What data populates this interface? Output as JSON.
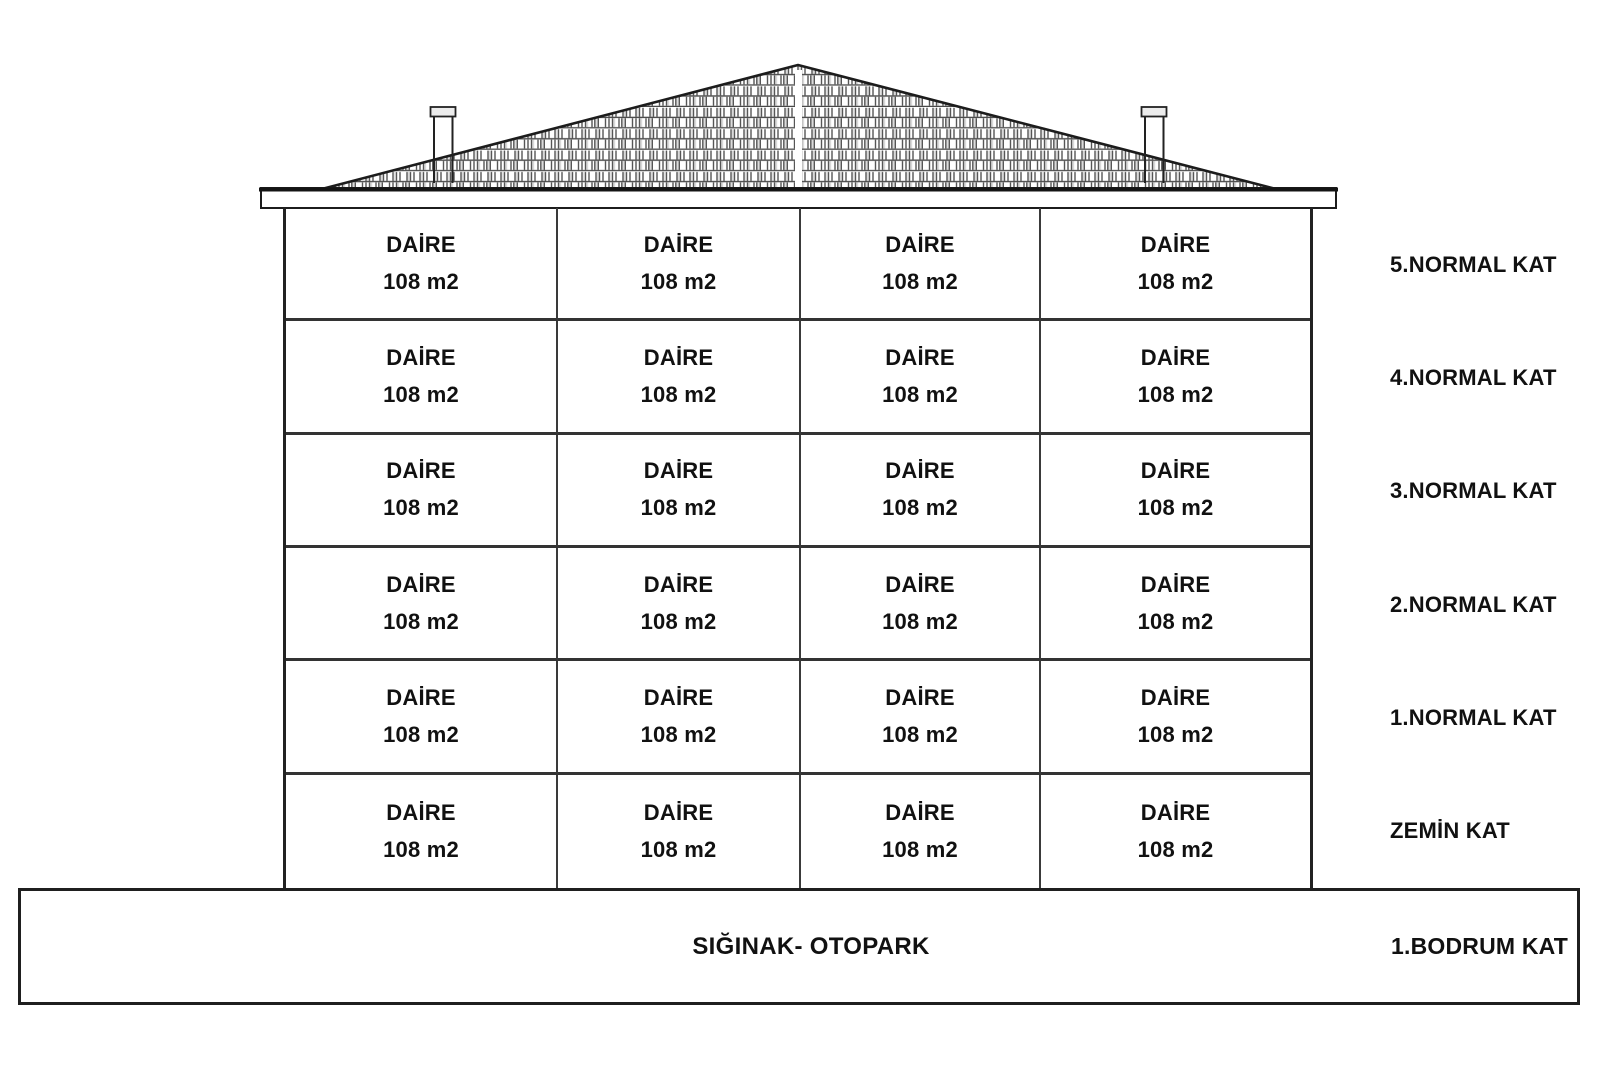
{
  "colors": {
    "background": "#ffffff",
    "ink": "#1a1a1a",
    "grid_line": "#333333"
  },
  "building": {
    "floors": [
      {
        "label": "5.NORMAL KAT",
        "units": [
          {
            "name": "DAİRE",
            "area": "108 m2"
          },
          {
            "name": "DAİRE",
            "area": "108 m2"
          },
          {
            "name": "DAİRE",
            "area": "108 m2"
          },
          {
            "name": "DAİRE",
            "area": "108 m2"
          }
        ]
      },
      {
        "label": "4.NORMAL KAT",
        "units": [
          {
            "name": "DAİRE",
            "area": "108 m2"
          },
          {
            "name": "DAİRE",
            "area": "108 m2"
          },
          {
            "name": "DAİRE",
            "area": "108 m2"
          },
          {
            "name": "DAİRE",
            "area": "108 m2"
          }
        ]
      },
      {
        "label": "3.NORMAL KAT",
        "units": [
          {
            "name": "DAİRE",
            "area": "108 m2"
          },
          {
            "name": "DAİRE",
            "area": "108 m2"
          },
          {
            "name": "DAİRE",
            "area": "108 m2"
          },
          {
            "name": "DAİRE",
            "area": "108 m2"
          }
        ]
      },
      {
        "label": "2.NORMAL KAT",
        "units": [
          {
            "name": "DAİRE",
            "area": "108 m2"
          },
          {
            "name": "DAİRE",
            "area": "108 m2"
          },
          {
            "name": "DAİRE",
            "area": "108 m2"
          },
          {
            "name": "DAİRE",
            "area": "108 m2"
          }
        ]
      },
      {
        "label": "1.NORMAL KAT",
        "units": [
          {
            "name": "DAİRE",
            "area": "108 m2"
          },
          {
            "name": "DAİRE",
            "area": "108 m2"
          },
          {
            "name": "DAİRE",
            "area": "108 m2"
          },
          {
            "name": "DAİRE",
            "area": "108 m2"
          }
        ]
      },
      {
        "label": "ZEMİN KAT",
        "units": [
          {
            "name": "DAİRE",
            "area": "108 m2"
          },
          {
            "name": "DAİRE",
            "area": "108 m2"
          },
          {
            "name": "DAİRE",
            "area": "108 m2"
          },
          {
            "name": "DAİRE",
            "area": "108 m2"
          }
        ]
      }
    ]
  },
  "basement": {
    "label": "SIĞINAK- OTOPARK",
    "floor_label": "1.BODRUM KAT"
  }
}
